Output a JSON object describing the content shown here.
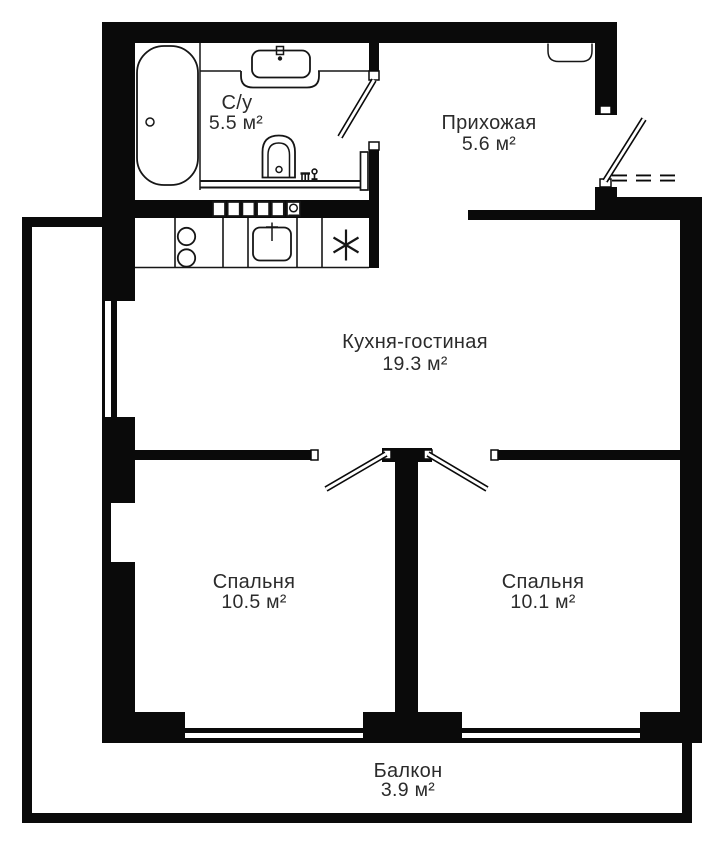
{
  "colors": {
    "wall": "#0a0a0a",
    "fixture_line": "#161616",
    "background": "#ffffff",
    "text": "#2b2b2b"
  },
  "rooms": [
    {
      "id": "bathroom",
      "label": "С/у",
      "area": "5.5 м²"
    },
    {
      "id": "hallway",
      "label": "Прихожая",
      "area": "5.6 м²"
    },
    {
      "id": "kitchen_living",
      "label": "Кухня-гостиная",
      "area": "19.3 м²"
    },
    {
      "id": "bedroom_1",
      "label": "Спальня",
      "area": "10.5 м²"
    },
    {
      "id": "bedroom_2",
      "label": "Спальня",
      "area": "10.1 м²"
    },
    {
      "id": "balcony",
      "label": "Балкон",
      "area": "3.9 м²"
    }
  ],
  "icons": [
    {
      "name": "bathtub-icon"
    },
    {
      "name": "bathroom-sink-icon"
    },
    {
      "name": "toilet-icon"
    },
    {
      "name": "washer-taps-icon"
    },
    {
      "name": "towel-radiator-icon"
    },
    {
      "name": "closet-niche-icon"
    },
    {
      "name": "vent-grille-icon"
    },
    {
      "name": "hob-two-burner-icon"
    },
    {
      "name": "kitchen-sink-icon"
    },
    {
      "name": "fridge-asterisk-icon",
      "glyph": "✳"
    },
    {
      "name": "door-leaf-icon"
    },
    {
      "name": "window-icon"
    }
  ]
}
